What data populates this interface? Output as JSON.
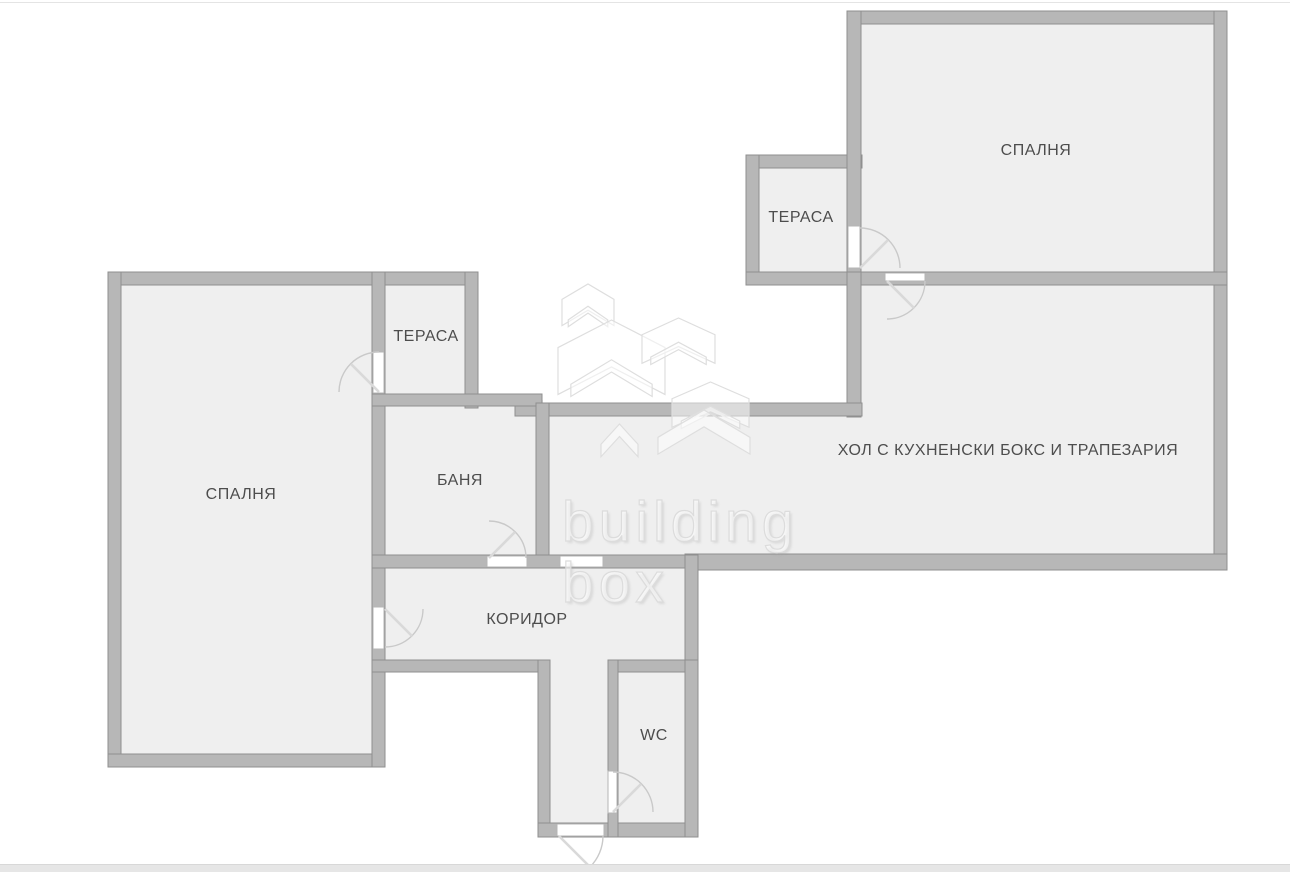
{
  "colors": {
    "background": "#ffffff",
    "wall_fill": "#b7b7b7",
    "wall_stroke": "#8f8f8f",
    "room_fill": "#efefef",
    "door_arc": "#c9c9c9",
    "door_leaf": "#d9d9d9",
    "door_panel_stroke": "#b5b5b5",
    "label_text": "#4d4d4d",
    "watermark_stroke": "#dedede",
    "top_border": "#e4e4e4",
    "bottom_bar": "#e6e6e6"
  },
  "plan": {
    "type": "apartment-floor-plan",
    "rooms": [
      {
        "name": "bedroom-top",
        "label": "СПАЛНЯ"
      },
      {
        "name": "terrace-top",
        "label": "ТЕРАСА"
      },
      {
        "name": "living-room",
        "label": "ХОЛ С КУХНЕНСКИ БОКС И ТРАПЕЗАРИЯ"
      },
      {
        "name": "bedroom-left",
        "label": "СПАЛНЯ"
      },
      {
        "name": "terrace-left",
        "label": "ТЕРАСА"
      },
      {
        "name": "bathroom",
        "label": "БАНЯ"
      },
      {
        "name": "corridor",
        "label": "КОРИДОР"
      },
      {
        "name": "wc",
        "label": "WC"
      }
    ]
  },
  "watermark": {
    "line1": "building",
    "line2": "box"
  }
}
